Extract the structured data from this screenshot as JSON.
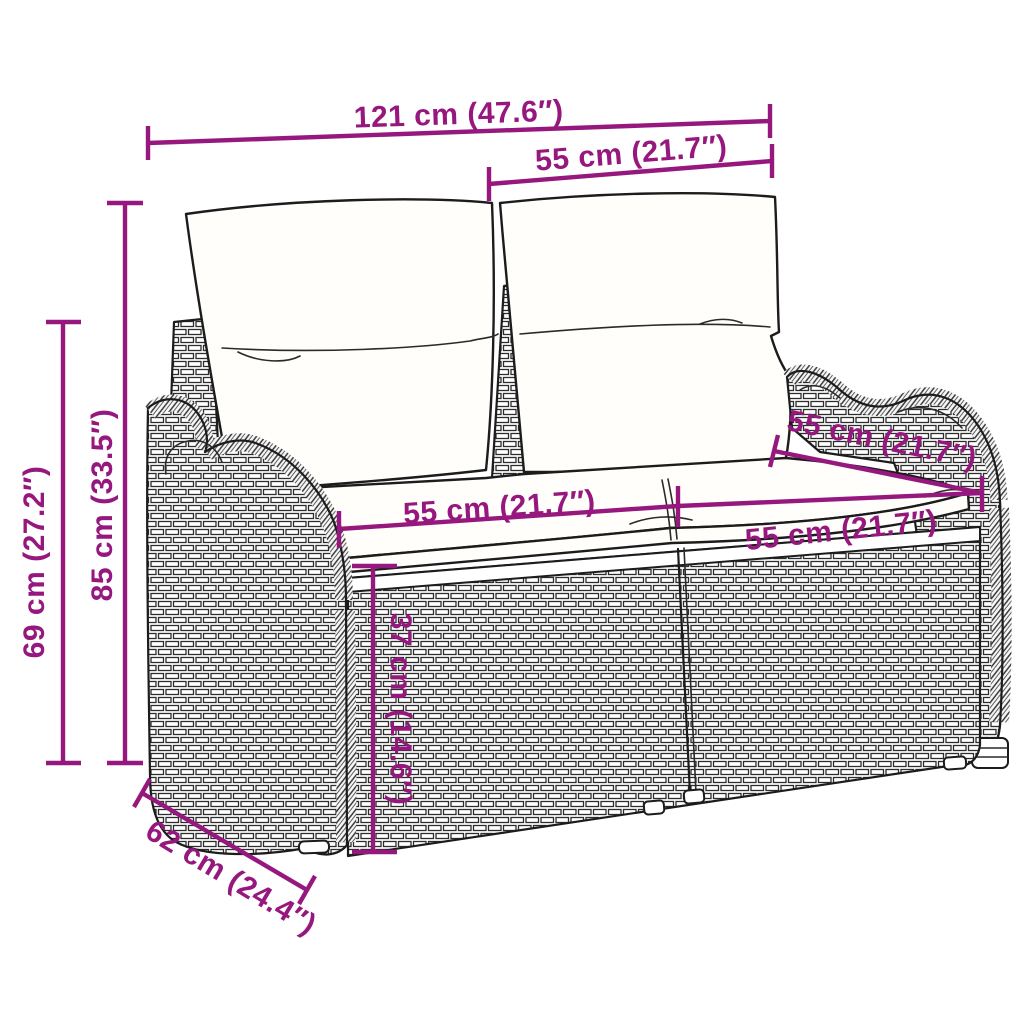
{
  "colors": {
    "accent": "#96187E",
    "background": "#FFFFFF",
    "linework": "#1C1C1C"
  },
  "diagram": {
    "subject": "poly-rattan-2-seater-garden-sofa-with-cushions",
    "dimensions": {
      "overall_width": "121 cm (47.6″)",
      "back_cushion_width": "55 cm (21.7″)",
      "total_height": "85 cm (33.5″)",
      "armrest_height": "69 cm (27.2″)",
      "left_seat_width": "55 cm (21.7″)",
      "right_seat_width": "55 cm (21.7″)",
      "seat_depth": "55 cm (21.7″)",
      "seat_height": "37 cm (14.6″)",
      "base_depth": "62 cm (24.4″)"
    }
  }
}
